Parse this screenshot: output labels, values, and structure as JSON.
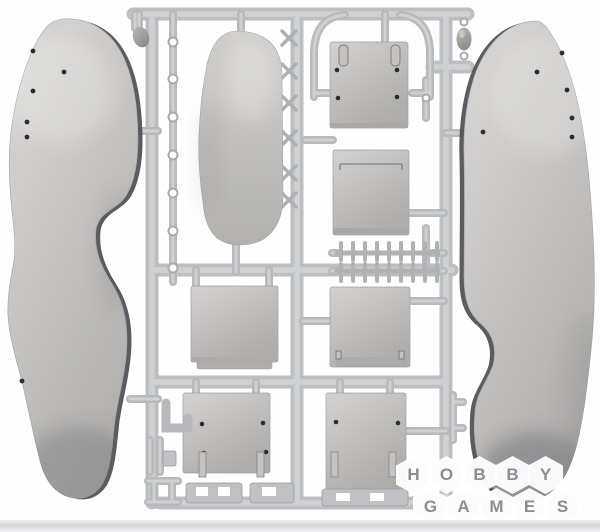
{
  "scene": {
    "type": "product-photo",
    "subject": "Gray plastic scale-model sprue (injection-molded parts frame) with flat body panels, a rounded pontoon part, rectangular floor panels, ladder-rack strips and small fittings, photographed on a white background"
  },
  "colors": {
    "bg": "#fefefe",
    "sprue_main": "#bdbec1",
    "sprue_light": "#d2d3d5",
    "sprue_minor": "#b8b9bc",
    "ladder": "#b1b2b4",
    "clip_mark": "#aeafb2",
    "part_hi": "#d3d2d0",
    "part_mid": "#c4c3c1",
    "part_lo": "#aeadab",
    "part_stroke": "#9fa0a2",
    "blob_hi": "#bab9b7",
    "blob_lo": "#8f8e8c",
    "edge_dark": "#4d4e52",
    "hole": "#2c2d30",
    "shade": "#63646a",
    "wm_letter": "#8b8d91",
    "strip_hi": "#ededef",
    "strip_lo": "#d7d7d9"
  },
  "watermark": {
    "row1": [
      "H",
      "O",
      "B",
      "B",
      "Y"
    ],
    "row2": [
      "G",
      "A",
      "M",
      "E",
      "S"
    ]
  },
  "parts": [
    "sprue-frame",
    "left-body-side-panel",
    "right-body-side-panel",
    "pontoon-part",
    "hatch-panel-top-right",
    "hull-panel-upper-right",
    "ladder-rack-strips",
    "floor-panel-mid-left",
    "floor-panel-mid-right",
    "floor-panel-bottom-left",
    "floor-panel-bottom-right",
    "channel-brackets",
    "small-runner-fittings"
  ]
}
